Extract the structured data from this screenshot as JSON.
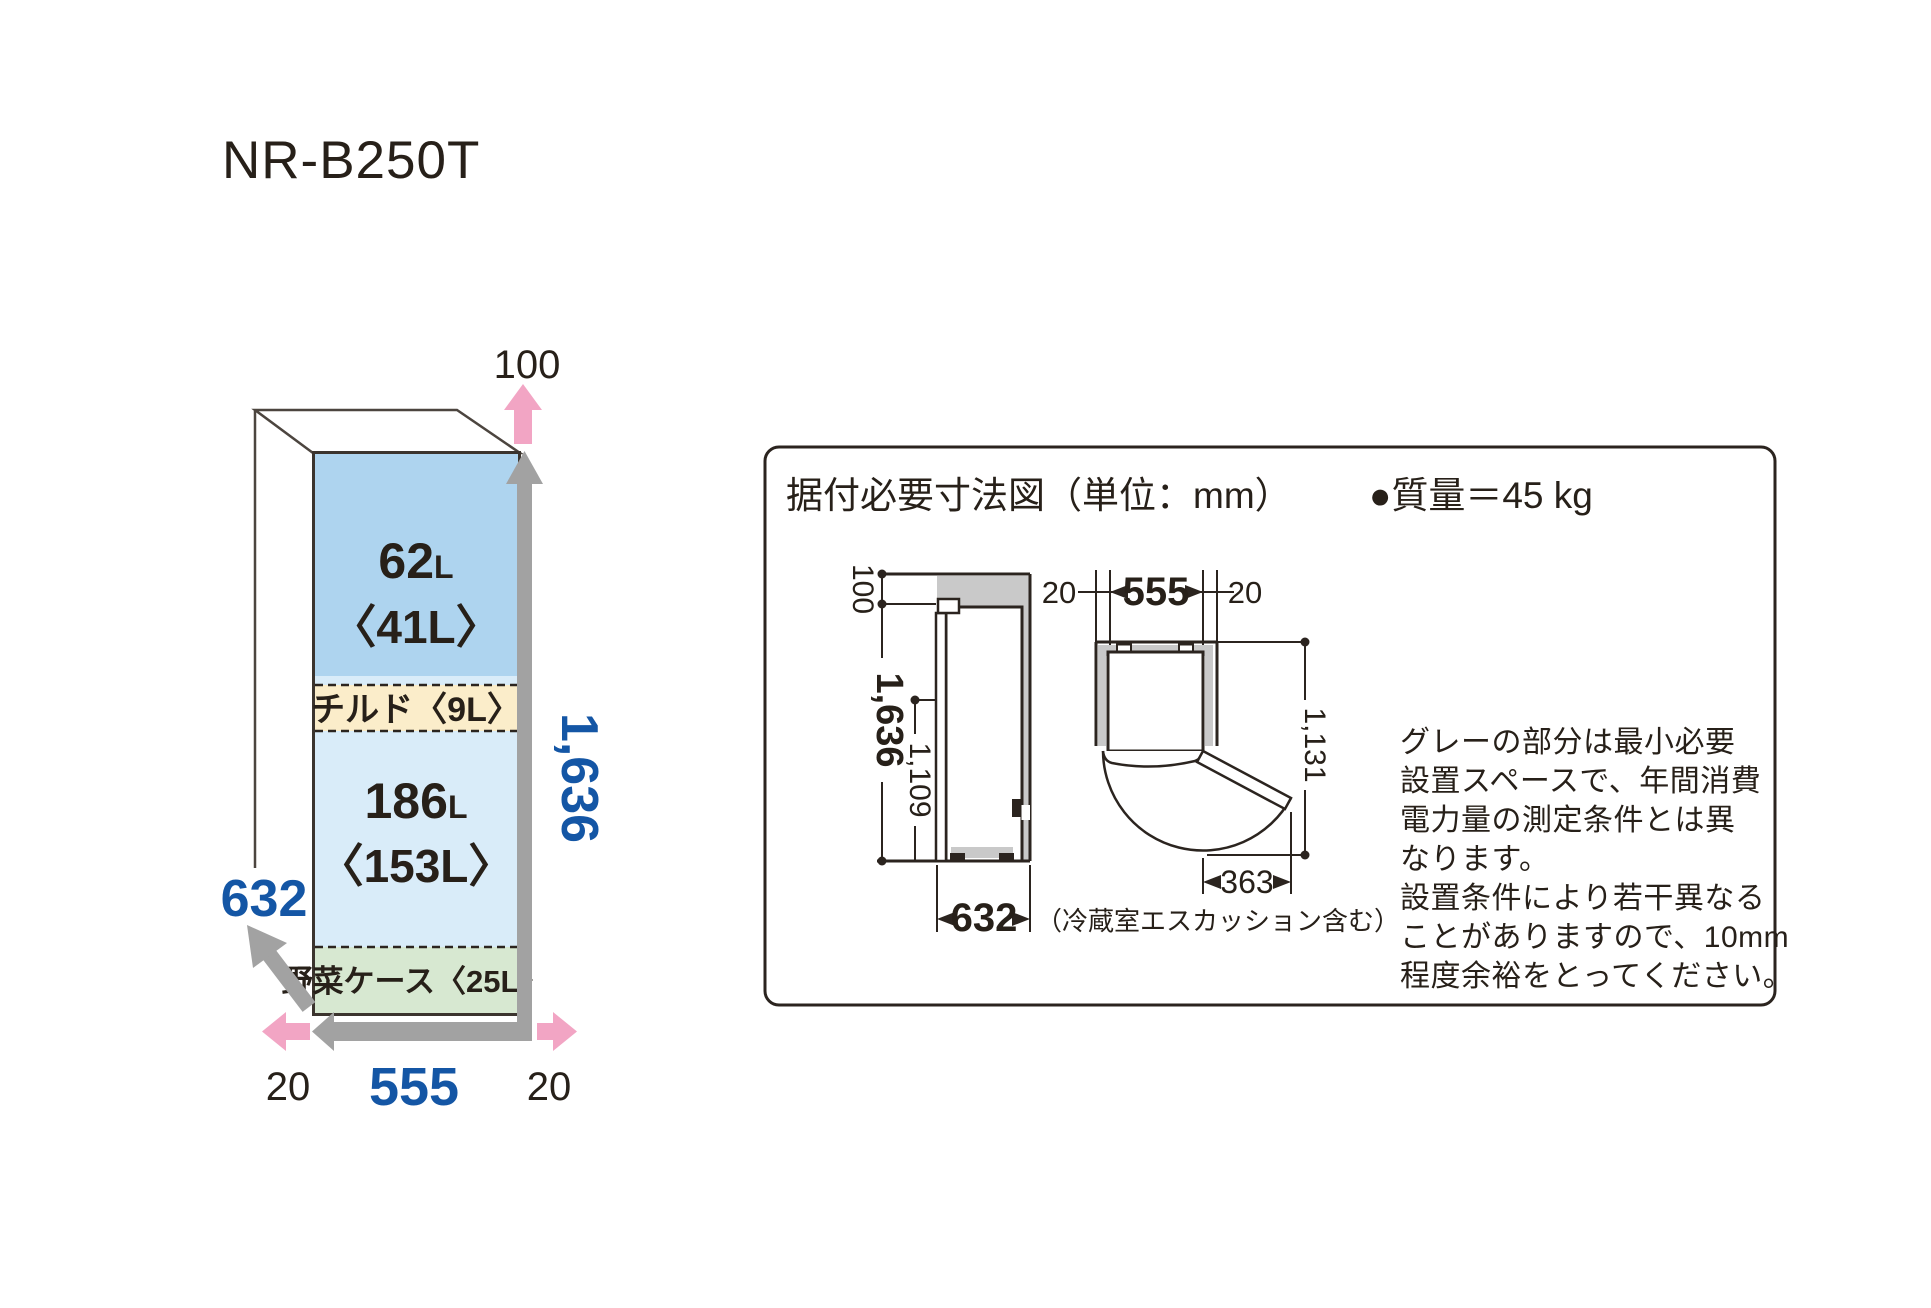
{
  "title": "NR-B250T",
  "fridge": {
    "freezer_num": "62",
    "freezer_unit": "L",
    "freezer_sub": "〈41L〉",
    "chilled": "チルド〈9L〉",
    "fridge_num": "186",
    "fridge_unit": "L",
    "fridge_sub": "〈153L〉",
    "vegetable": "野菜ケース〈25L〉",
    "dim_top": "100",
    "dim_height": "1,636",
    "dim_depth": "632",
    "dim_width": "555",
    "dim_gap_left": "20",
    "dim_gap_right": "20"
  },
  "panel": {
    "heading": "据付必要寸法図（単位：mm）",
    "weight": "●質量＝45 kg",
    "side_view": {
      "top_clearance": "100",
      "height": "1,636",
      "door_top_height": "1,109",
      "depth": "632",
      "depth_note": "（冷蔵室エスカッション含む）"
    },
    "top_view": {
      "gap_left": "20",
      "width": "555",
      "gap_right": "20",
      "open_depth": "1,131",
      "door_swing": "363"
    },
    "note_lines": [
      "グレーの部分は最小必要",
      "設置スペースで、年間消費",
      "電力量の測定条件とは異",
      "なります。",
      "設置条件により若干異なる",
      "ことがありますので、10mm",
      "程度余裕をとってください。"
    ]
  },
  "colors": {
    "accent_blue": "#1456a5",
    "pink": "#f2a5c4",
    "arrow_gray": "#a2a2a2",
    "space_gray": "#c9c9c9",
    "freezer_blue": "#aed4ef",
    "fridge_blue": "#d9ecf9",
    "chilled_cream": "#fbedca",
    "vegetable_green": "#d7e8d1",
    "line_dark": "#2b241f"
  }
}
